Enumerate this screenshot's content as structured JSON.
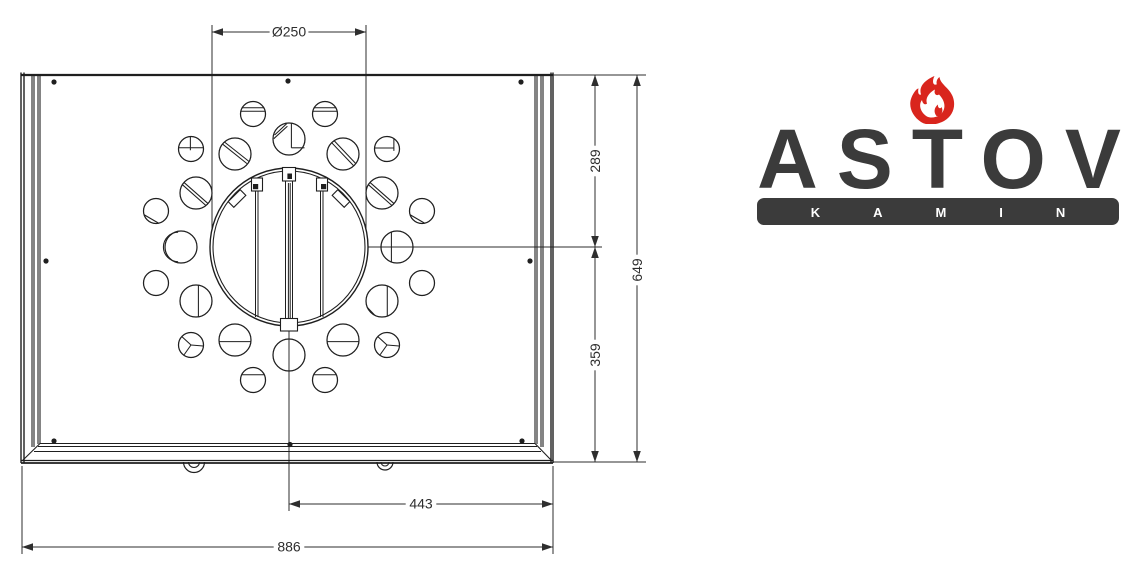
{
  "drawing": {
    "ink": "#1f1f1f",
    "dim_ink": "#2e2e2e",
    "label_font_px": 14,
    "structure": [
      [
        21,
        75,
        553,
        75,
        2.2
      ],
      [
        21,
        72.5,
        21,
        463,
        1.4
      ],
      [
        24,
        72.5,
        24,
        463,
        1.4
      ],
      [
        32,
        75,
        32,
        447,
        1.1
      ],
      [
        34,
        75,
        34,
        447,
        1.1
      ],
      [
        38,
        76,
        38,
        444,
        1.1
      ],
      [
        40,
        76,
        40,
        444,
        1.1
      ],
      [
        553,
        72.5,
        553,
        463,
        1.4
      ],
      [
        551,
        72.5,
        551,
        463,
        1.4
      ],
      [
        543,
        75,
        543,
        447,
        1.1
      ],
      [
        541,
        75,
        541,
        447,
        1.1
      ],
      [
        537,
        76,
        537,
        444,
        1.1
      ],
      [
        535,
        76,
        535,
        444,
        1.1
      ],
      [
        40,
        443.5,
        535,
        443.5,
        1.1
      ],
      [
        38,
        446.5,
        537,
        446.5,
        1.1
      ],
      [
        34,
        451.5,
        541,
        451.5,
        1.1
      ],
      [
        21,
        460.5,
        553,
        460.5,
        1.2
      ],
      [
        21,
        463,
        553,
        463,
        1.8
      ],
      [
        40,
        443.5,
        22,
        461,
        1.1
      ],
      [
        535,
        443.5,
        552,
        461,
        1.1
      ]
    ],
    "screws": [
      [
        54,
        82
      ],
      [
        288,
        81
      ],
      [
        521,
        82
      ],
      [
        46,
        261
      ],
      [
        530,
        261
      ],
      [
        54,
        441
      ],
      [
        290,
        444.5
      ],
      [
        522,
        441
      ]
    ],
    "collar": {
      "cx": 289,
      "cy": 247,
      "r_outer": 79,
      "r_inner": 76,
      "bars": [
        [
          255.5,
          191,
          255.5,
          317
        ],
        [
          258,
          191,
          258,
          317
        ],
        [
          320.5,
          191,
          320.5,
          317
        ],
        [
          323,
          191,
          323,
          317
        ],
        [
          285.5,
          181,
          285.5,
          318
        ],
        [
          288.4,
          183,
          288.4,
          318
        ],
        [
          290.2,
          183,
          290.2,
          318
        ],
        [
          292.5,
          181,
          292.5,
          318
        ]
      ],
      "tabs": [
        [
          282.5,
          167.5,
          13,
          13.5
        ],
        [
          251.5,
          178,
          11,
          13
        ],
        [
          316.5,
          178,
          11,
          13
        ],
        [
          280.5,
          318.5,
          17,
          12.5
        ]
      ],
      "pins": [
        [
          287.4,
          173.5,
          4.6,
          5.5
        ],
        [
          253,
          184,
          5.2,
          5.2
        ],
        [
          321,
          184,
          5.2,
          5.2
        ]
      ],
      "notches": [
        [
          237,
          198.5,
          17,
          8,
          -45
        ],
        [
          341,
          198.5,
          17,
          8,
          45
        ]
      ]
    },
    "holes": [
      [
        289,
        139,
        16,
        "mixT"
      ],
      [
        343,
        154,
        16,
        "diagT"
      ],
      [
        382,
        193,
        16,
        "diag2"
      ],
      [
        397,
        247,
        16,
        "vlineL"
      ],
      [
        382,
        301,
        16,
        "vline2"
      ],
      [
        343,
        340,
        16,
        "hmid"
      ],
      [
        289,
        355,
        16,
        "none"
      ],
      [
        235,
        340,
        16,
        "hmid"
      ],
      [
        196,
        301,
        16,
        "vline"
      ],
      [
        181,
        247,
        16,
        "crescent"
      ],
      [
        196,
        193,
        16,
        "diag2"
      ],
      [
        235,
        154,
        16,
        "diag2b"
      ],
      [
        325,
        114,
        12.5,
        "h2"
      ],
      [
        387,
        149,
        12.5,
        "hv"
      ],
      [
        422,
        211,
        12.5,
        "diag1"
      ],
      [
        422,
        283,
        12.5,
        "none"
      ],
      [
        387,
        345,
        12.5,
        "y"
      ],
      [
        325,
        380,
        12.5,
        "h1"
      ],
      [
        253,
        380,
        12.5,
        "h1"
      ],
      [
        191,
        345,
        12.5,
        "y"
      ],
      [
        156,
        283,
        12.5,
        "none"
      ],
      [
        156,
        211,
        12.5,
        "diag1"
      ],
      [
        191,
        149,
        12.5,
        "cross"
      ],
      [
        253,
        114,
        12.5,
        "h2"
      ]
    ],
    "mark_defs": {
      "h2": [
        [
          -0.85,
          -0.5,
          0.85,
          -0.5
        ],
        [
          -0.97,
          -0.22,
          0.97,
          -0.22
        ]
      ],
      "h1": [
        [
          -0.88,
          -0.42,
          0.88,
          -0.42
        ]
      ],
      "hmid": [
        [
          -0.99,
          0.1,
          0.99,
          0.1
        ]
      ],
      "diag1": [
        [
          -0.95,
          0.3,
          0.2,
          0.97
        ]
      ],
      "diag2": [
        [
          -0.75,
          -0.66,
          0.75,
          0.66
        ],
        [
          -0.85,
          -0.52,
          0.62,
          0.78
        ]
      ],
      "diag2b": [
        [
          -0.66,
          -0.75,
          0.88,
          0.47
        ],
        [
          -0.78,
          -0.62,
          0.75,
          0.6
        ]
      ],
      "diagT": [
        [
          -0.55,
          -0.83,
          0.8,
          0.6
        ],
        [
          -0.7,
          -0.7,
          0.65,
          0.72
        ]
      ],
      "cross": [
        [
          -0.05,
          -0.99,
          -0.05,
          0.1
        ],
        [
          -0.99,
          -0.1,
          0.99,
          -0.1
        ]
      ],
      "hv": [
        [
          -0.99,
          -0.08,
          0.55,
          -0.08
        ],
        [
          0.55,
          -0.8,
          0.55,
          0.15
        ]
      ],
      "vline": [
        [
          0.15,
          -0.98,
          0.15,
          0.98
        ]
      ],
      "vlineL": [
        [
          -0.35,
          -0.93,
          -0.35,
          0.93
        ]
      ],
      "vline2": [
        [
          0.33,
          -0.94,
          0.33,
          0.94
        ],
        [
          -0.92,
          0.4,
          -0.45,
          0.89
        ]
      ],
      "y": [
        [
          0,
          0,
          0.97,
          0.08
        ],
        [
          0,
          0,
          -0.72,
          -0.66
        ],
        [
          0,
          0,
          -0.55,
          0.78
        ]
      ],
      "mixT": [
        [
          -0.9,
          -0.25,
          -0.15,
          -0.95
        ],
        [
          -0.95,
          -0.02,
          -0.1,
          -0.8
        ],
        [
          0.15,
          -0.98,
          0.15,
          0.55
        ],
        [
          0.15,
          0.55,
          0.97,
          0.55
        ]
      ],
      "none": []
    },
    "hooks": [
      [
        194,
        10.5,
        5.5
      ],
      [
        385,
        8,
        4
      ]
    ],
    "ext_lines": [
      [
        212,
        25,
        212,
        229
      ],
      [
        366,
        25,
        366,
        229
      ],
      [
        553,
        75,
        646,
        75
      ],
      [
        368,
        247,
        602,
        247
      ],
      [
        553,
        462,
        646,
        462
      ],
      [
        289,
        331,
        289,
        511
      ],
      [
        22,
        466,
        22,
        554
      ],
      [
        553,
        466,
        553,
        554
      ]
    ],
    "dims": [
      {
        "label": "Ø250",
        "line": [
          212,
          32,
          366,
          32
        ],
        "arrows": [
          [
            "l",
            212,
            32
          ],
          [
            "r",
            366,
            32
          ]
        ],
        "tx": 289,
        "ty": 31.5,
        "rot": 0
      },
      {
        "label": "289",
        "line": [
          595,
          75,
          595,
          247
        ],
        "arrows": [
          [
            "u",
            595,
            75
          ],
          [
            "d",
            595,
            247
          ]
        ],
        "tx": 595,
        "ty": 161,
        "rot": -90
      },
      {
        "label": "359",
        "line": [
          595,
          247,
          595,
          462
        ],
        "arrows": [
          [
            "u",
            595,
            247
          ],
          [
            "d",
            595,
            462
          ]
        ],
        "tx": 595,
        "ty": 355,
        "rot": -90
      },
      {
        "label": "649",
        "line": [
          637,
          75,
          637,
          462
        ],
        "arrows": [
          [
            "u",
            637,
            75
          ],
          [
            "d",
            637,
            462
          ]
        ],
        "tx": 637,
        "ty": 270,
        "rot": -90
      },
      {
        "label": "443",
        "line": [
          289,
          504,
          553,
          504
        ],
        "arrows": [
          [
            "l",
            289,
            504
          ],
          [
            "r",
            553,
            504
          ]
        ],
        "tx": 421,
        "ty": 503.5,
        "rot": 0
      },
      {
        "label": "886",
        "line": [
          22,
          547,
          553,
          547
        ],
        "arrows": [
          [
            "l",
            22,
            547
          ],
          [
            "r",
            553,
            547
          ]
        ],
        "tx": 289,
        "ty": 546.5,
        "rot": 0
      }
    ]
  },
  "logo": {
    "brand": "ASTOV",
    "kamin": "KAMIN",
    "text_color": "#3b3b3b",
    "badge_color": "#3b3b3b",
    "kamin_text_color": "#ffffff",
    "flame_color": "#d9251d"
  }
}
